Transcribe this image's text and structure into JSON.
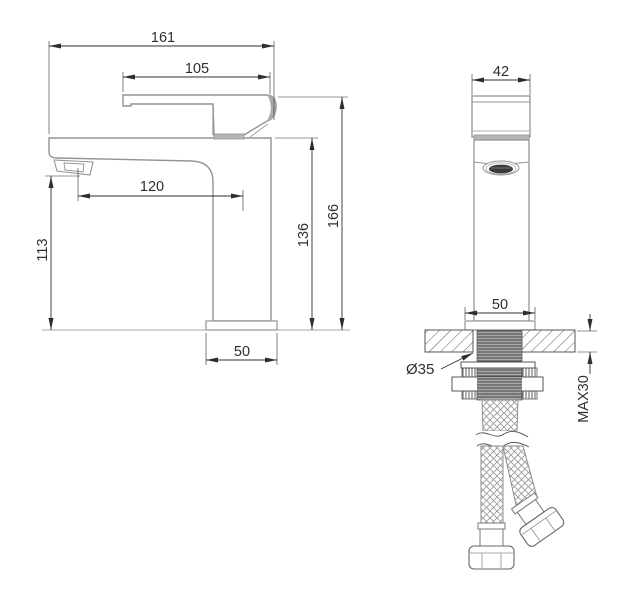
{
  "meta": {
    "type": "technical-dimension-drawing",
    "subject": "single-lever basin faucet, side view and front installation view"
  },
  "side_view": {
    "total_length": "161",
    "handle_length": "105",
    "spout_reach": "120",
    "spout_height": "113",
    "body_height": "136",
    "total_height": "166",
    "base_width": "50"
  },
  "front_view": {
    "handle_width": "42",
    "base_width": "50",
    "hole_diameter": "Ø35",
    "max_deck_thickness": "MAX30"
  },
  "colors": {
    "background": "#ffffff",
    "outline": "#949494",
    "dimension_line": "#3a3a3a",
    "shade": "#b5b5b5",
    "hatch": "#5f5f5f"
  }
}
